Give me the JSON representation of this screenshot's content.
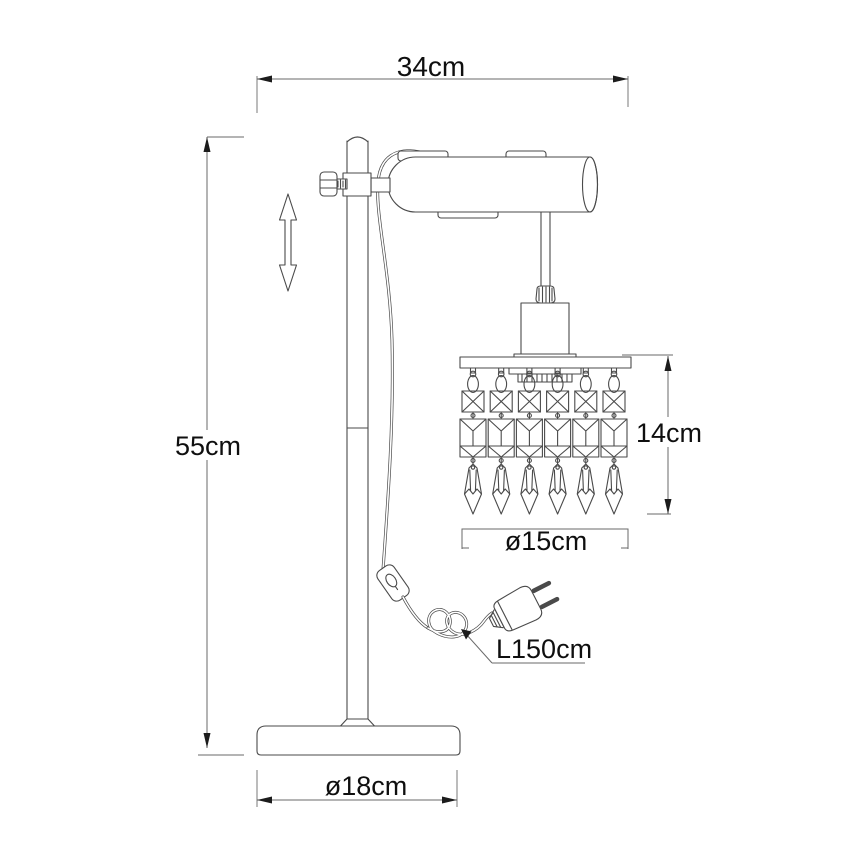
{
  "drawing": {
    "labels": {
      "overall_width": "34cm",
      "overall_height": "55cm",
      "crystal_section_height": "14cm",
      "crystal_section_diameter": "ø15cm",
      "base_diameter": "ø18cm",
      "cable_length": "L150cm"
    },
    "crystal_strand_count": 6,
    "colors": {
      "line": "#4a4a4a",
      "dimension": "#6a6a6a",
      "arrow": "#1c1c1c",
      "text": "#0f0f0f",
      "background": "#ffffff"
    }
  }
}
